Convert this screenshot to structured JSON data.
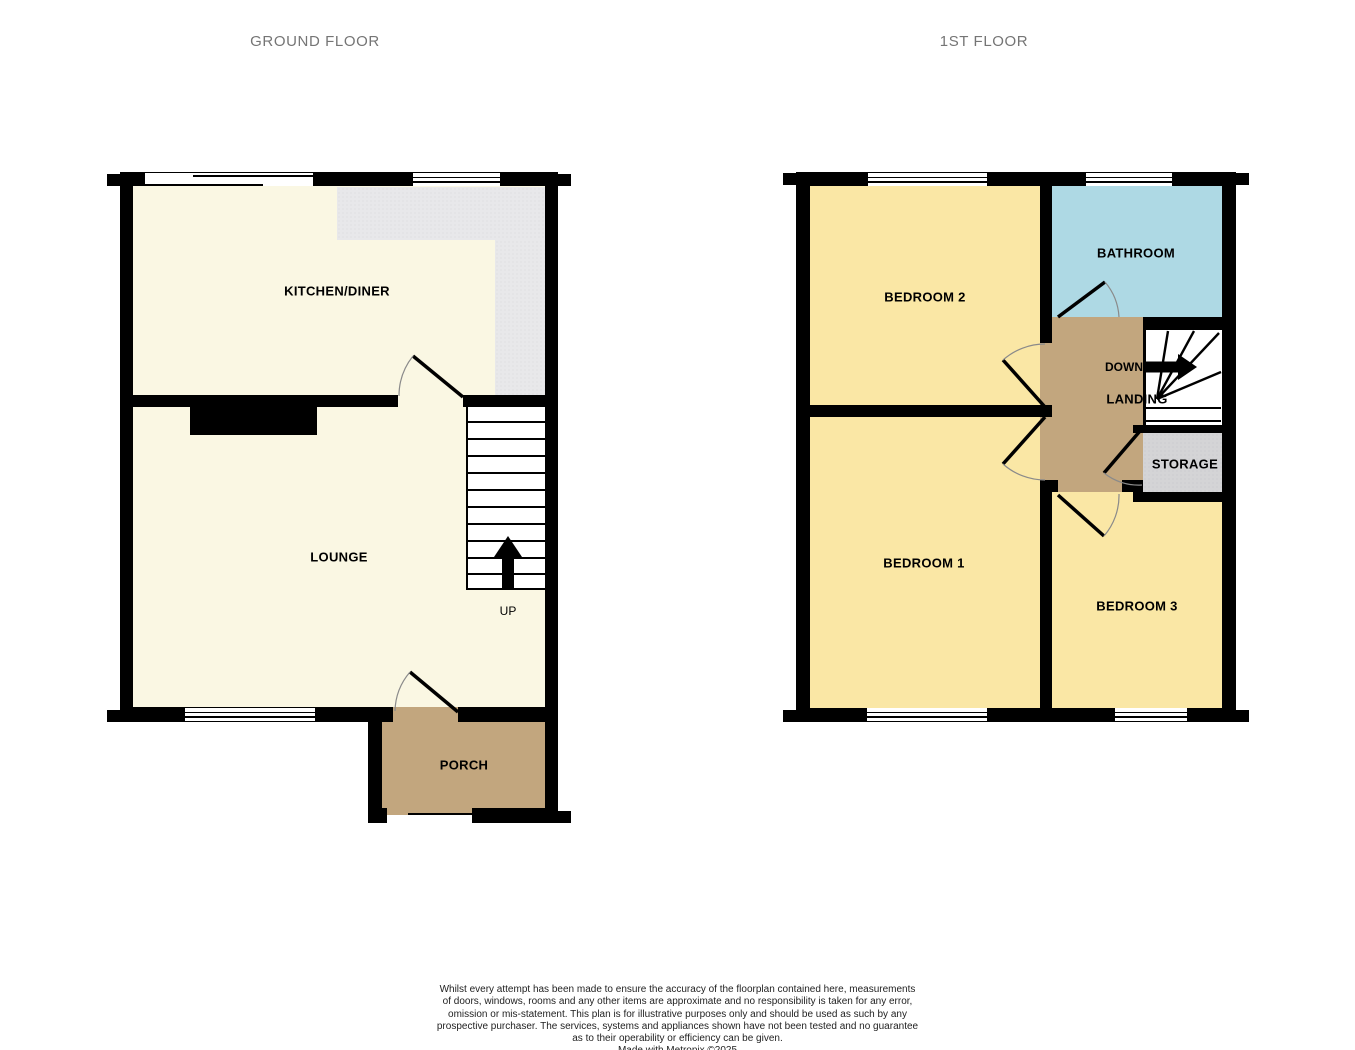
{
  "titles": {
    "ground_floor": "GROUND FLOOR",
    "first_floor": "1ST FLOOR"
  },
  "ground_floor": {
    "rooms": {
      "kitchen_diner": "KITCHEN/DINER",
      "lounge": "LOUNGE",
      "porch": "PORCH"
    },
    "stairs_label": "UP"
  },
  "first_floor": {
    "rooms": {
      "bedroom2": "BEDROOM 2",
      "bathroom": "BATHROOM",
      "landing": "LANDING",
      "storage": "STORAGE",
      "bedroom1": "BEDROOM 1",
      "bedroom3": "BEDROOM 3"
    },
    "stairs_label": "DOWN"
  },
  "colors": {
    "wall": "#000000",
    "cream_floor": "#FAF7E3",
    "bedroom_yellow": "#FAE7A5",
    "bathroom_blue": "#AED9E4",
    "hall_tan": "#C2A67E",
    "storage_gray": "#D4D4D6",
    "counter_gray": "#E8E8EA",
    "title_gray": "#757575"
  },
  "disclaimer": {
    "lines": [
      "Whilst every attempt has been made to ensure the accuracy of the floorplan contained here, measurements",
      "of doors, windows, rooms and any other items are approximate and no responsibility is taken for any error,",
      "omission or mis-statement. This plan is for illustrative purposes only and should be used as such by any",
      "prospective purchaser. The services, systems and appliances shown have not been tested and no guarantee",
      "as to their operability or efficiency can be given.",
      "Made with Metropix ©2025"
    ]
  }
}
